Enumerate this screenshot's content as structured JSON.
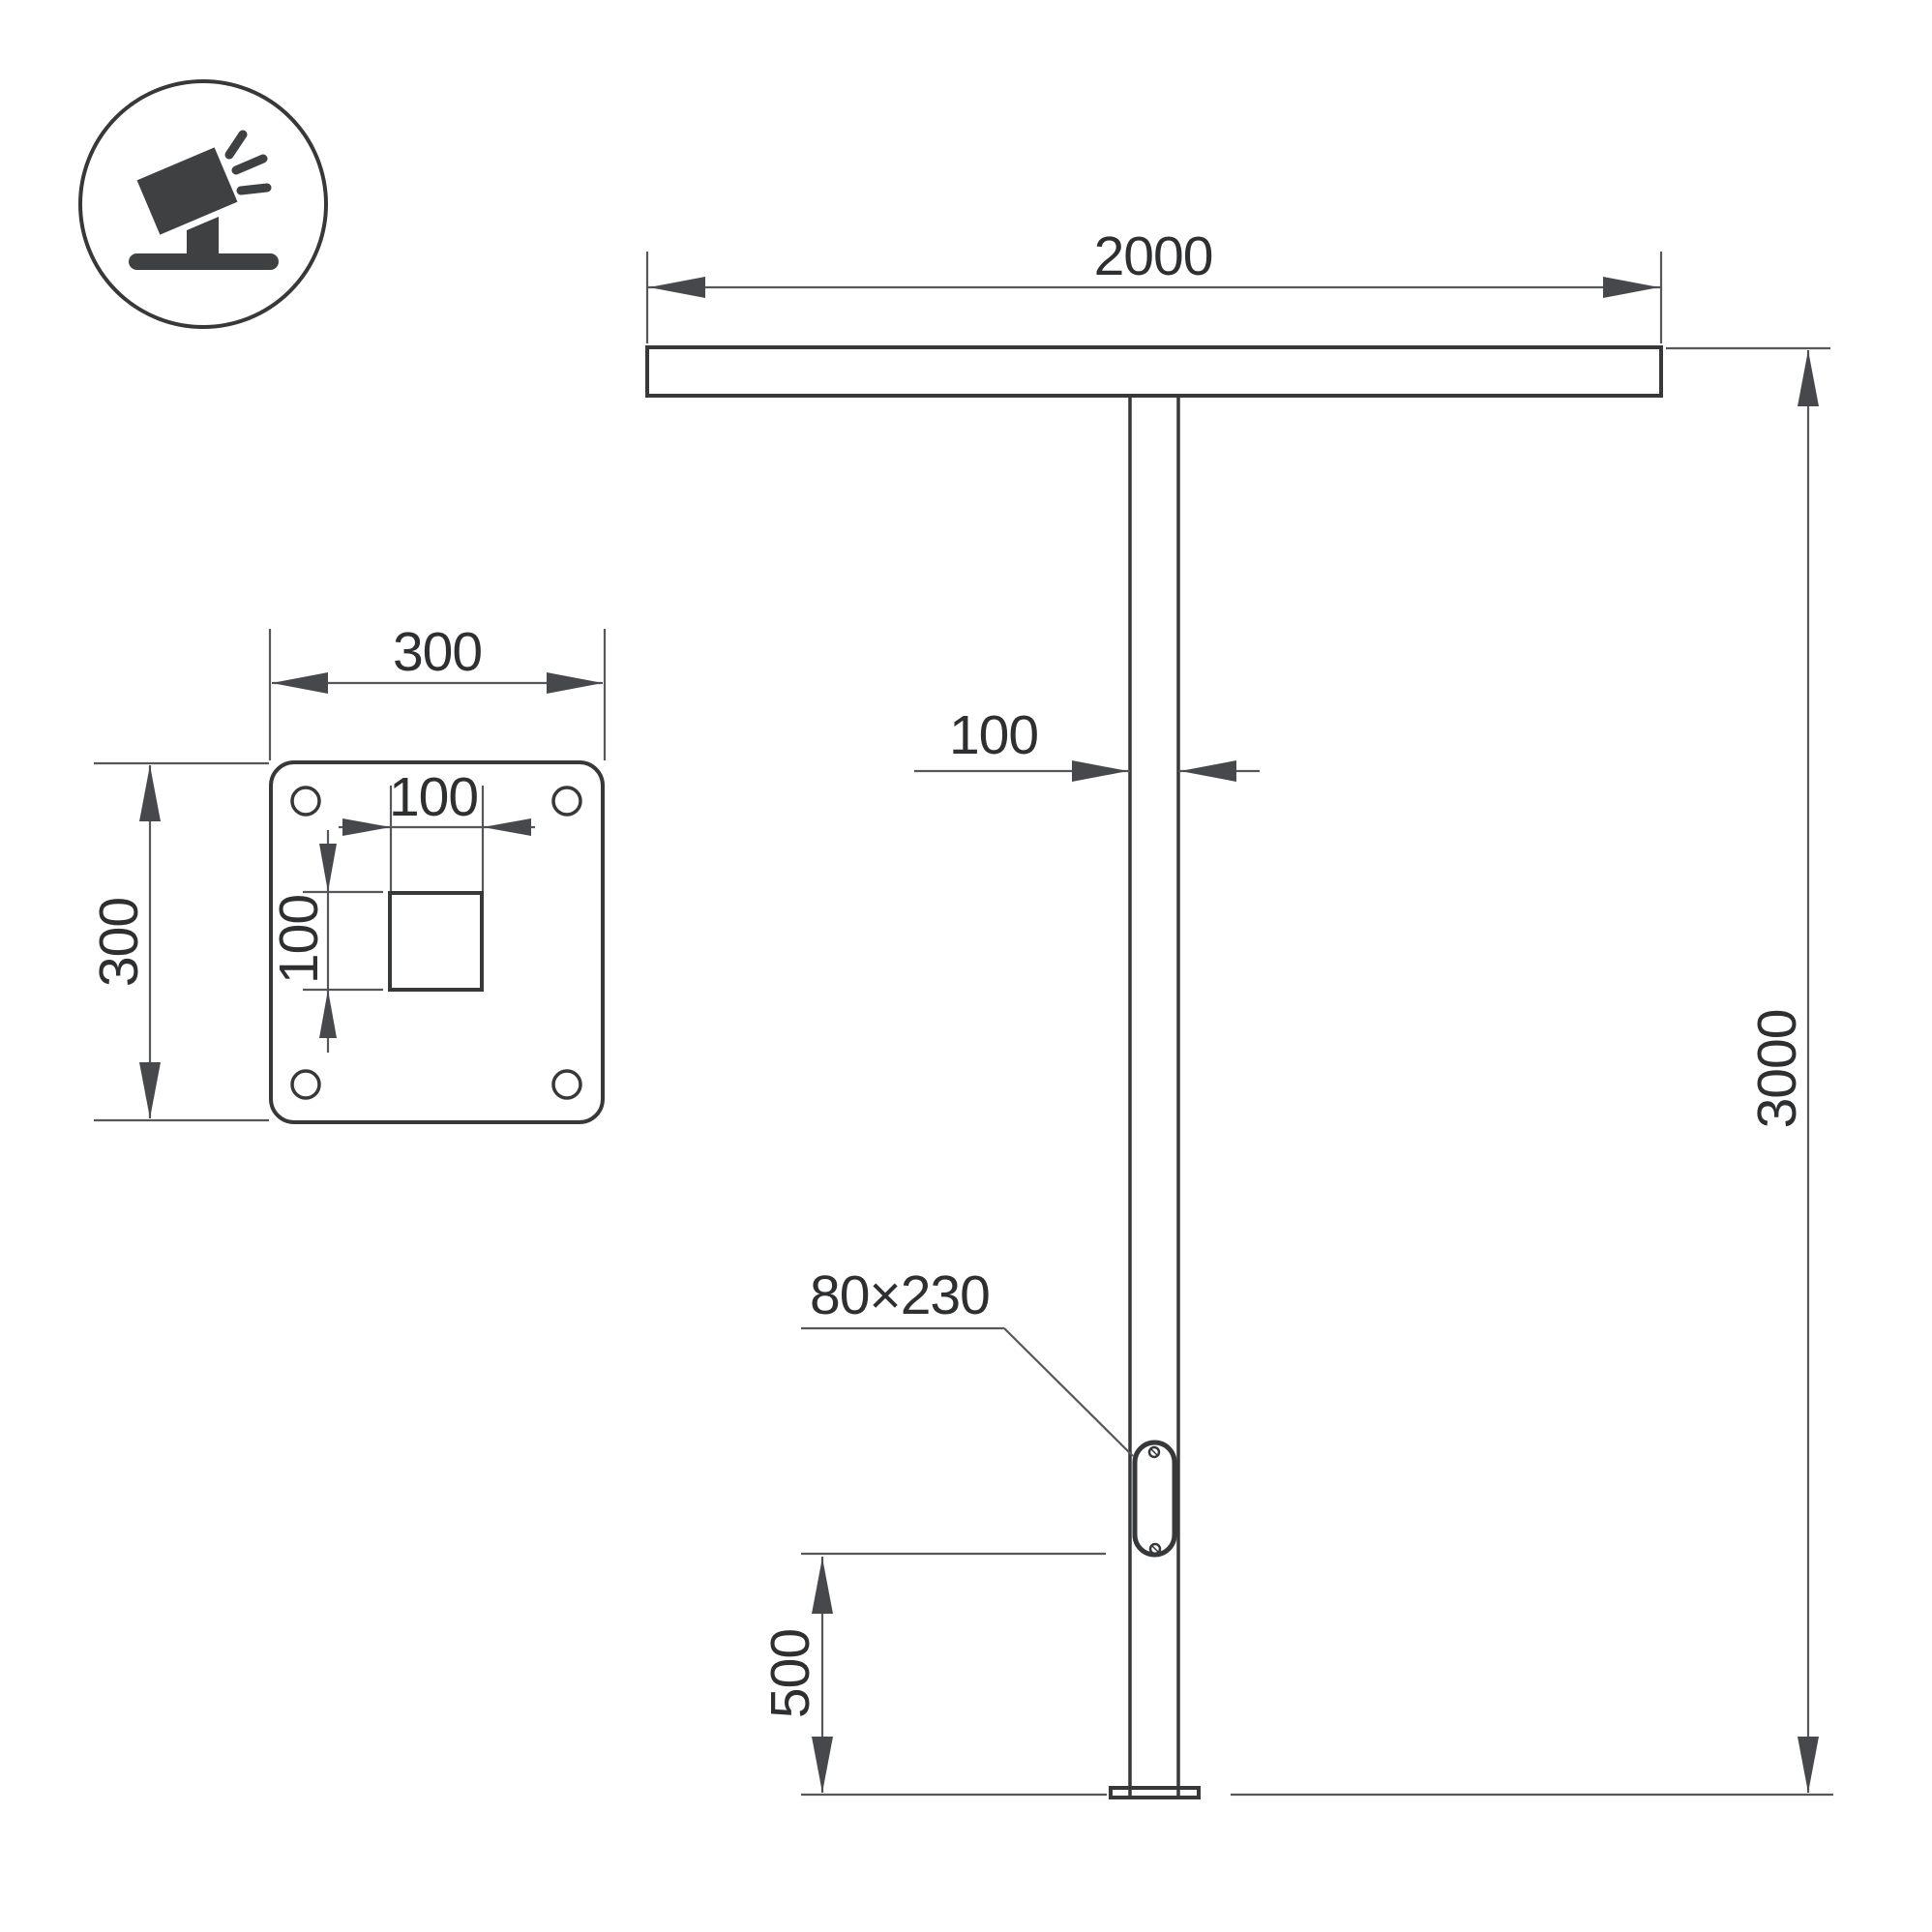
{
  "title": "T-shaped street pole technical drawing",
  "colors": {
    "background": "#ffffff",
    "drawing_line": "#37383a",
    "dimension_line": "#56575a",
    "text": "#2e2f31",
    "icon": "#3f4042"
  },
  "icon": {
    "name": "tilted-floodlight-on-stand",
    "description": "circled pictogram of a floodlight projector on a ground stand emitting light rays"
  },
  "elevation": {
    "crossbar_width": "2000",
    "pole_height": "3000",
    "pole_width": "100",
    "handhole_size": "80×230",
    "handhole_height": "500"
  },
  "plate": {
    "width": "300",
    "height": "300",
    "slot_width": "100",
    "slot_height": "100"
  }
}
